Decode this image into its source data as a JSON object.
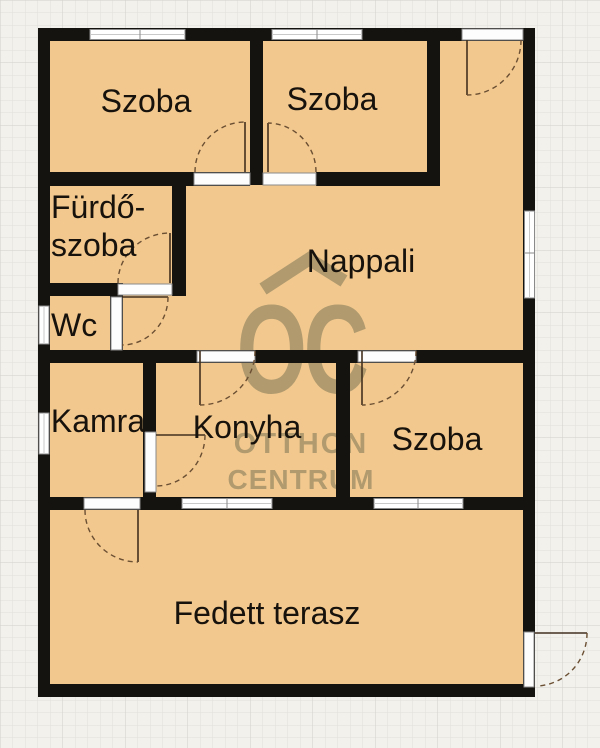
{
  "plan": {
    "title": "Floor plan",
    "rooms": [
      {
        "id": "szoba-top-left",
        "label": "Szoba"
      },
      {
        "id": "szoba-top-middle",
        "label": "Szoba"
      },
      {
        "id": "furdoszoba",
        "label": "Fürdő-szoba",
        "lines": [
          "Fürdő-",
          "szoba"
        ]
      },
      {
        "id": "wc",
        "label": "Wc"
      },
      {
        "id": "nappali",
        "label": "Nappali"
      },
      {
        "id": "kamra",
        "label": "Kamra"
      },
      {
        "id": "konyha",
        "label": "Konyha"
      },
      {
        "id": "szoba-bottom-right",
        "label": "Szoba"
      },
      {
        "id": "fedett-terasz",
        "label": "Fedett terasz"
      }
    ],
    "watermark": {
      "logo": "OC",
      "line1": "OTTHON",
      "line2": "CENTRUM"
    },
    "colors": {
      "background": "#f2f1ec",
      "grid_minor": "#e2e0da",
      "grid_major": "#d2d0ca",
      "room_fill": "#f2c88e",
      "wall": "#151310",
      "window_fill": "#ffffff",
      "window_border": "#8a8a8a",
      "door_leaf": "#42301e",
      "door_arc": "#6b4f33",
      "watermark": "#b09a6e",
      "label_text": "#17120c"
    }
  }
}
